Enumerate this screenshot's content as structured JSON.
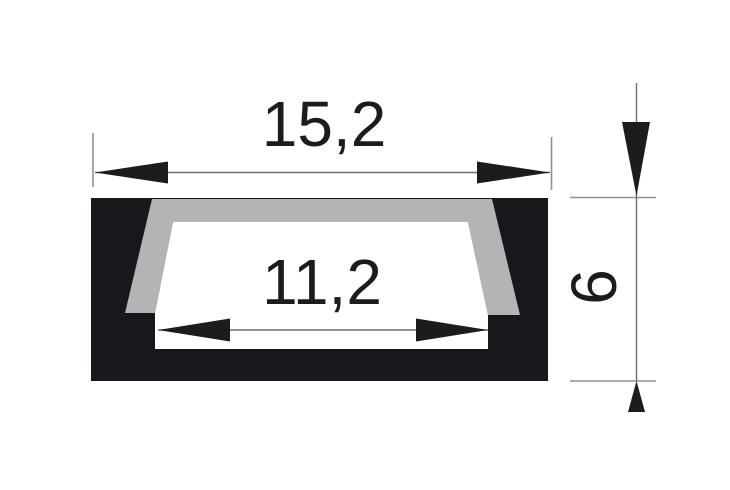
{
  "drawing": {
    "kind": "profile-cross-section-dimension-drawing",
    "dimensions": {
      "width_total": {
        "label": "15,2"
      },
      "width_inner": {
        "label": "11,2"
      },
      "height": {
        "label": "6"
      }
    }
  },
  "colors": {
    "background": "#ffffff",
    "body": "#17181b",
    "diffuser": "#b3b4b6",
    "cavity": "#ffffff",
    "ink": "#1b1c1e",
    "dim_line": "#6e6e6e",
    "ext_line": "#919191"
  }
}
